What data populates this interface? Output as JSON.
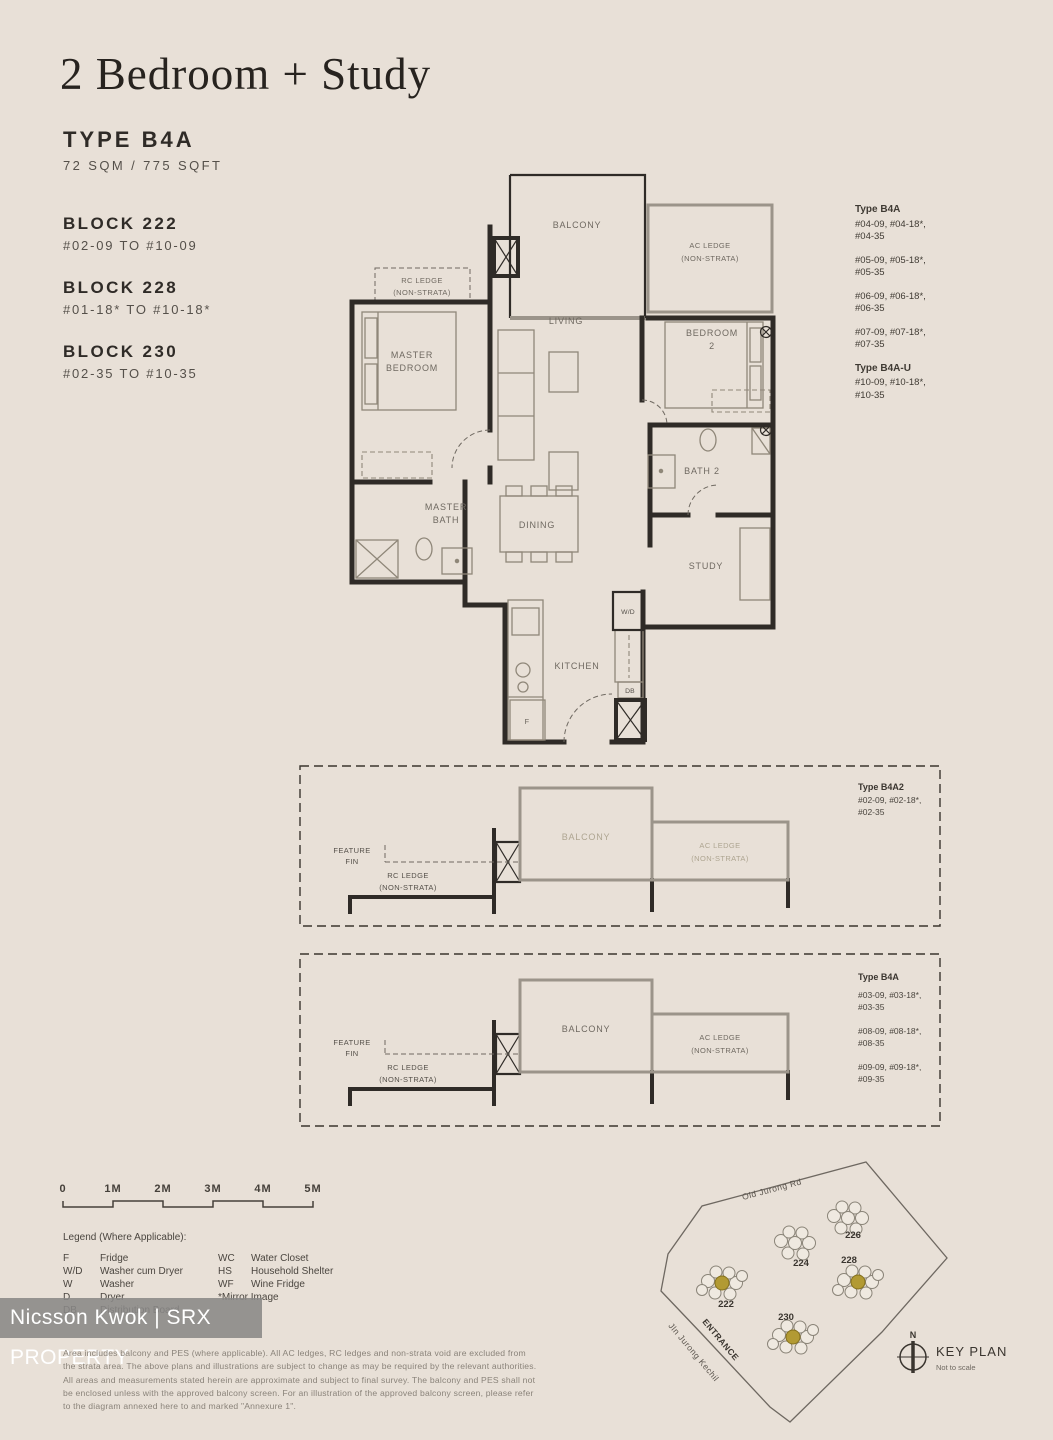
{
  "header": {
    "title": "2 Bedroom + Study"
  },
  "unit": {
    "type_label": "TYPE B4A",
    "area": "72 SQM / 775 SQFT"
  },
  "blocks": [
    {
      "name": "BLOCK 222",
      "range": "#02-09 TO #10-09"
    },
    {
      "name": "BLOCK 228",
      "range": "#01-18* TO #10-18*"
    },
    {
      "name": "BLOCK 230",
      "range": "#02-35 TO #10-35"
    }
  ],
  "stacks": {
    "groups": [
      {
        "title": "Type B4A",
        "entries": [
          [
            "#04-09, #04-18*,",
            "#04-35"
          ],
          [
            "#05-09, #05-18*,",
            "#05-35"
          ],
          [
            "#06-09, #06-18*,",
            "#06-35"
          ],
          [
            "#07-09, #07-18*,",
            "#07-35"
          ]
        ]
      },
      {
        "title": "Type B4A-U",
        "entries": [
          [
            "#10-09, #10-18*,",
            "#10-35"
          ]
        ]
      }
    ]
  },
  "plan": {
    "balcony": "BALCONY",
    "ac_ledge": [
      "AC LEDGE",
      "(NON-STRATA)"
    ],
    "rc_ledge": [
      "RC LEDGE",
      "(NON-STRATA)"
    ],
    "living": "LIVING",
    "master_bedroom": [
      "MASTER",
      "BEDROOM"
    ],
    "bedroom2": [
      "BEDROOM",
      "2"
    ],
    "bath2": "BATH 2",
    "master_bath": [
      "MASTER",
      "BATH"
    ],
    "dining": "DINING",
    "study": "STUDY",
    "kitchen": "KITCHEN",
    "wd": "W/D",
    "db": "DB",
    "fridge": "F"
  },
  "section_upper": {
    "feature_fin": [
      "FEATURE",
      "FIN"
    ],
    "rc_ledge": [
      "RC LEDGE",
      "(NON-STRATA)"
    ],
    "balcony": "BALCONY",
    "ac_ledge": [
      "AC LEDGE",
      "(NON-STRATA)"
    ],
    "units_title": "Type B4A2",
    "units": [
      "#02-09, #02-18*,",
      "#02-35"
    ]
  },
  "section_lower": {
    "feature_fin": [
      "FEATURE",
      "FIN"
    ],
    "rc_ledge": [
      "RC LEDGE",
      "(NON-STRATA)"
    ],
    "balcony": "BALCONY",
    "ac_ledge": [
      "AC LEDGE",
      "(NON-STRATA)"
    ],
    "units_title": "Type B4A",
    "units": [
      [
        "#03-09, #03-18*,",
        "#03-35"
      ],
      [
        "#08-09, #08-18*,",
        "#08-35"
      ],
      [
        "#09-09, #09-18*,",
        "#09-35"
      ]
    ]
  },
  "scale_bar": {
    "labels": [
      "0",
      "1M",
      "2M",
      "3M",
      "4M",
      "5M"
    ]
  },
  "legend": {
    "title": "Legend (Where Applicable):",
    "col1": [
      {
        "abbr": "F",
        "label": "Fridge"
      },
      {
        "abbr": "W/D",
        "label": "Washer cum Dryer"
      },
      {
        "abbr": "W",
        "label": "Washer"
      },
      {
        "abbr": "D",
        "label": "Dryer"
      },
      {
        "abbr": "DB",
        "label": "Distribution Board"
      }
    ],
    "col2": [
      {
        "abbr": "WC",
        "label": "Water Closet"
      },
      {
        "abbr": "HS",
        "label": "Household Shelter"
      },
      {
        "abbr": "WF",
        "label": "Wine Fridge"
      }
    ],
    "note": "*Mirror Image"
  },
  "watermark": {
    "text": "Nicsson Kwok | SRX PROPERTY"
  },
  "disclaimer": "Area includes balcony and PES (where applicable). All AC ledges, RC ledges and non-strata void are excluded from the strata area. The above plans and illustrations are subject to change as may be required by the relevant authorities. All areas and measurements stated herein are approximate and subject to final survey. The balcony and PES shall not be enclosed unless with the approved balcony screen. For an illustration of the approved balcony screen, please refer to the diagram annexed here to and marked \"Annexure 1\".",
  "key_plan": {
    "road_top": "Old Jurong Rd",
    "road_left": "Jln Jurong Kechil",
    "entrance": "ENTRANCE",
    "blocks": [
      "222",
      "224",
      "226",
      "228",
      "230"
    ],
    "compass": "N",
    "title": "KEY PLAN",
    "subtitle": "Not to scale"
  },
  "colors": {
    "background": "#e8e0d7",
    "wall_ink": "#2f2b27",
    "ledge_gray": "#9b948a",
    "label_gray": "#6f6961",
    "highlight": "#b29a33",
    "watermark_bg": "#898886",
    "watermark_text": "#ffffff"
  }
}
